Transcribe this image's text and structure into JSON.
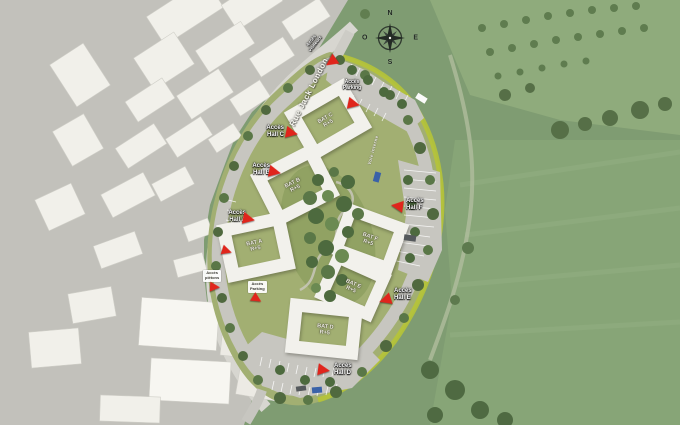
{
  "map": {
    "compass": {
      "n": "N",
      "e": "E",
      "s": "S",
      "w": "O"
    },
    "streets": {
      "rue": "Rue Jack London",
      "voie": "Voie interne"
    },
    "buildings": {
      "a": {
        "name": "BAT A",
        "level": "R+5"
      },
      "b": {
        "name": "BAT B",
        "level": "R+5"
      },
      "c": {
        "name": "BAT C",
        "level": "R+5"
      },
      "d": {
        "name": "BAT D",
        "level": "R+5"
      },
      "e": {
        "name": "BAT E",
        "level": "R+5"
      },
      "f": {
        "name": "BAT F",
        "level": "R+5"
      }
    },
    "access": {
      "hall_a": {
        "l1": "Accès",
        "l2": "Hall A"
      },
      "hall_b": {
        "l1": "Accès",
        "l2": "Hall B"
      },
      "hall_c": {
        "l1": "Accès",
        "l2": "Hall C"
      },
      "hall_d": {
        "l1": "Accès",
        "l2": "Hall D"
      },
      "hall_e": {
        "l1": "Accès",
        "l2": "Hall E"
      },
      "hall_f": {
        "l1": "Accès",
        "l2": "Hall F"
      },
      "parking_north": {
        "l1": "Accès",
        "l2": "Parking"
      },
      "parking_south": {
        "l1": "Accès",
        "l2": "Parking"
      },
      "pedestrian": {
        "l1": "Accès",
        "l2": "piétons"
      },
      "visitor": {
        "l1": "Accès",
        "l2": "visiteurs"
      }
    },
    "colors": {
      "marker_red": "#e0251c",
      "hedge_green": "#b6c437",
      "site_lawn": "#a2af72",
      "park_green": "#7f9c72",
      "road_gray": "#c7c6c0",
      "building_white": "#f2f1ec"
    }
  }
}
